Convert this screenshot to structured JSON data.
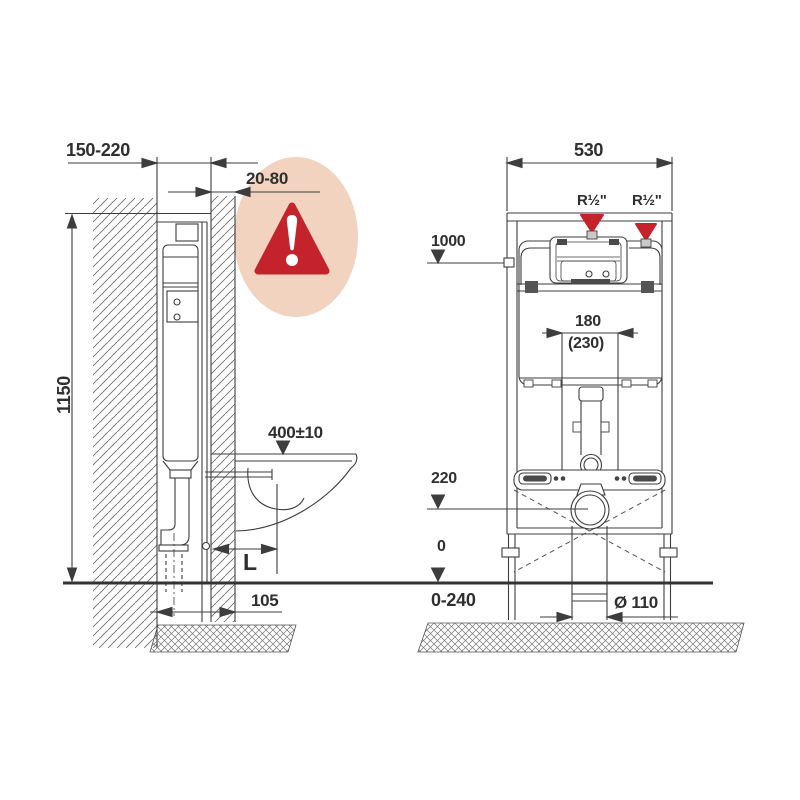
{
  "colors": {
    "line": "#3d3d3d",
    "warning_red": "#c5232b",
    "bubble_peach": "#f1d3c0",
    "floor": "#333333"
  },
  "warning": {
    "panel_gap_label": "20-80"
  },
  "side_view": {
    "wall_distance": "150-220",
    "height": "1150",
    "bowl_height": "400±10",
    "length_label": "L",
    "drain_offset": "105"
  },
  "front_view": {
    "width": "530",
    "water_left": "R½\"",
    "water_right": "R½\"",
    "water_height": "1000",
    "drain_spacing": "180",
    "drain_spacing_alt": "(230)",
    "outlet_height": "220",
    "floor": "0",
    "adjust_range": "0-240",
    "drain_diameter": "Ø 110"
  }
}
